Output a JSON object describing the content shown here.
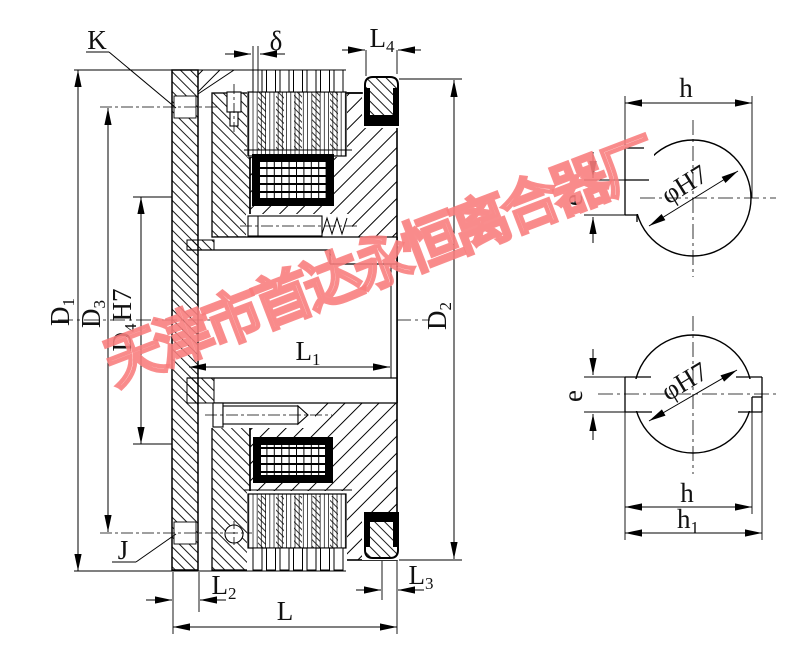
{
  "watermark": {
    "text": "天津市首达永恒离合器厂",
    "color": "#f87d7d"
  },
  "main_view": {
    "callouts": {
      "K": "K",
      "J": "J"
    },
    "dims": {
      "delta": "δ",
      "D1": {
        "base": "D",
        "sub": "1"
      },
      "D2": {
        "base": "D",
        "sub": "2"
      },
      "D3": {
        "base": "D",
        "sub": "3"
      },
      "D4": {
        "base": "D",
        "sub": "4",
        "suffix": "H7"
      },
      "L": "L",
      "L1": {
        "base": "L",
        "sub": "1"
      },
      "L2": {
        "base": "L",
        "sub": "2"
      },
      "L3": {
        "base": "L",
        "sub": "3"
      },
      "L4": {
        "base": "L",
        "sub": "4"
      }
    }
  },
  "detail_top": {
    "h": "h",
    "e": "e",
    "bore": "φH7"
  },
  "detail_bottom": {
    "h": "h",
    "e": "e",
    "bore": "φH7",
    "h1": {
      "base": "h",
      "sub": "1"
    }
  }
}
